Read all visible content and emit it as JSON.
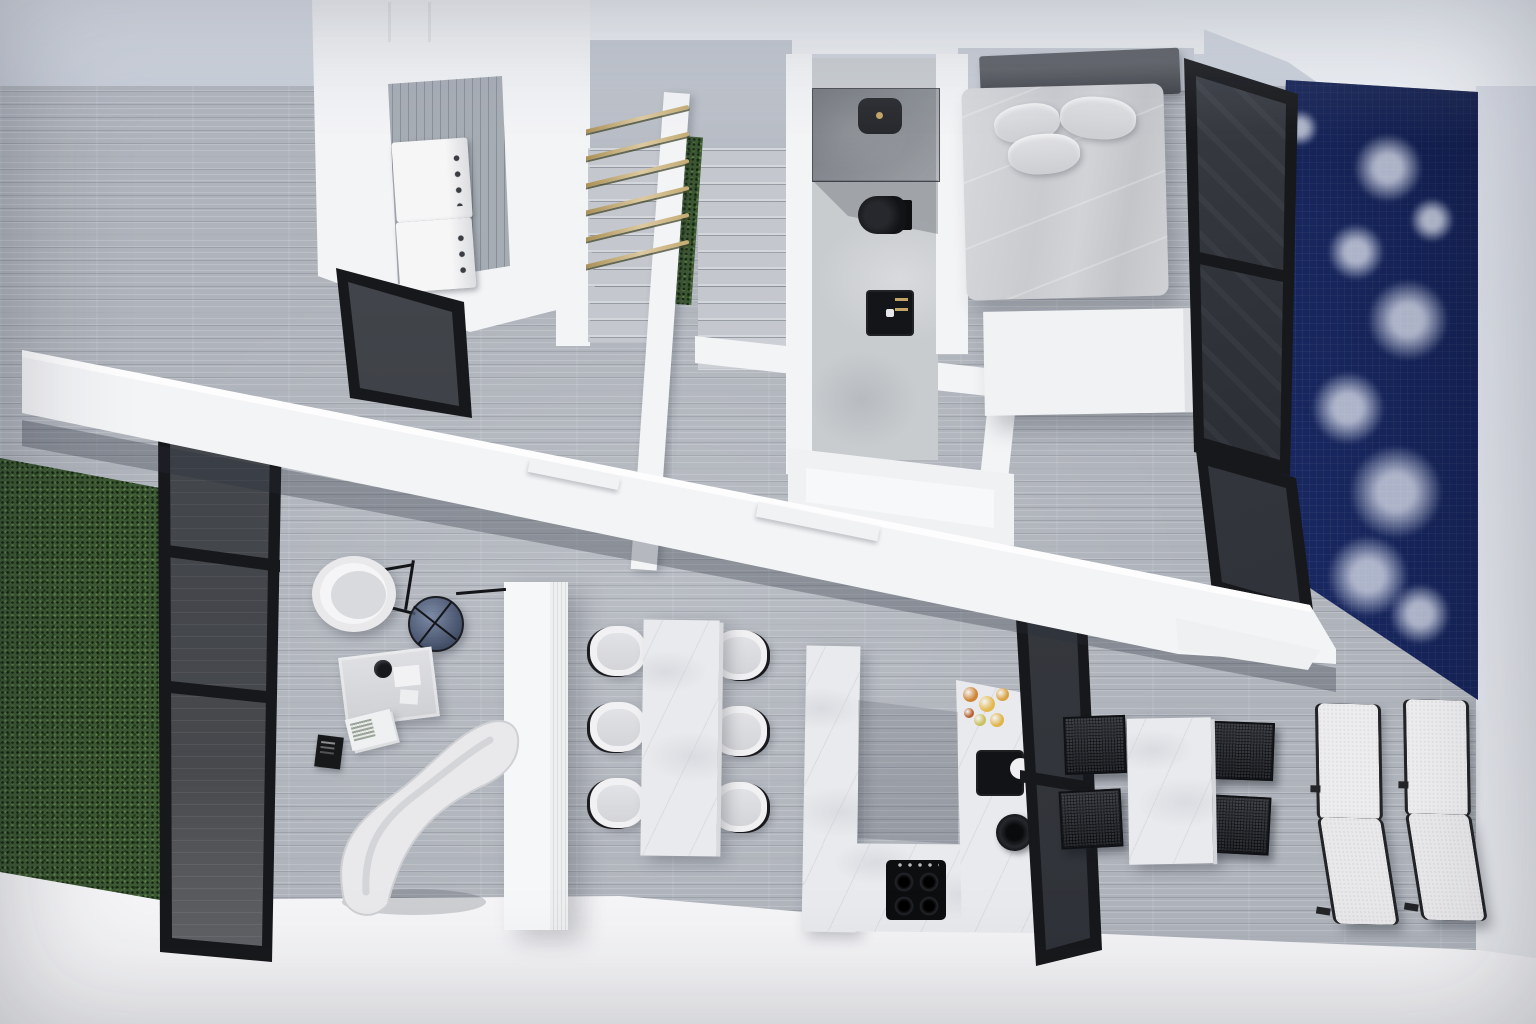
{
  "scene": {
    "description": "Top-down 3D architectural render of a modern duplex apartment with indoor pool, no visible text",
    "rooms": [
      "laundry-closet",
      "staircase",
      "bathroom",
      "bedroom",
      "pool",
      "living-area",
      "dining-area",
      "kitchen",
      "outdoor-dining-terrace",
      "green-plant-wall"
    ],
    "objects": [
      "stacked-washer-dryer",
      "stair-railing",
      "glass-shower",
      "black-toilet",
      "black-sink",
      "double-bed",
      "pillows",
      "wardrobe-unit",
      "glass-partitions",
      "dining-table-six-chairs",
      "u-shaped-kitchen-counter",
      "gas-cooktop",
      "fruit-bowl",
      "armchair",
      "round-glass-side-table",
      "side-table",
      "chaise-lounge",
      "fluted-column",
      "outdoor-table-mesh-chairs",
      "two-sun-loungers"
    ]
  },
  "palette": {
    "floor": "#b2b7bf",
    "wall": "#f3f4f6",
    "band": "#d3d8e1",
    "concrete": "#c9cccf",
    "marble": "#e9eaed",
    "grass1": "#3d5834",
    "poolA": "#1b2c6b",
    "poolB": "#2a418f",
    "black": "#17181b",
    "glass": "#5a6068",
    "gold": "#c3a366",
    "bed": "#cdcfd3",
    "hb": "#45484e",
    "seat": "#d8d9dc",
    "shell": "#f1f1f3",
    "mesh": "#26282d",
    "chaise": "#e9e9eb"
  },
  "railing": {
    "rung_count": 6,
    "rung_y": [
      130,
      157,
      184,
      211,
      238,
      265
    ]
  },
  "pool_foam": [
    {
      "x": 1388,
      "y": 168,
      "r": 34
    },
    {
      "x": 1356,
      "y": 252,
      "r": 28
    },
    {
      "x": 1408,
      "y": 320,
      "r": 40
    },
    {
      "x": 1348,
      "y": 408,
      "r": 36
    },
    {
      "x": 1396,
      "y": 492,
      "r": 46
    },
    {
      "x": 1368,
      "y": 576,
      "r": 40
    },
    {
      "x": 1420,
      "y": 614,
      "r": 30
    },
    {
      "x": 1338,
      "y": 652,
      "r": 26
    },
    {
      "x": 1300,
      "y": 128,
      "r": 18
    },
    {
      "x": 1432,
      "y": 220,
      "r": 22
    }
  ],
  "dining": {
    "left_x": 590,
    "right_x": 711,
    "left_rows": [
      626,
      702,
      778
    ],
    "right_rows": [
      630,
      706,
      782
    ],
    "chair_count": 6
  },
  "cooktop_burners": [
    {
      "x": 8,
      "y": 12
    },
    {
      "x": 33,
      "y": 12
    },
    {
      "x": 8,
      "y": 36
    },
    {
      "x": 33,
      "y": 36
    }
  ],
  "fruit": [
    {
      "x": 978,
      "y": 702,
      "r": 15,
      "c": "#cf8434"
    },
    {
      "x": 995,
      "y": 712,
      "r": 16,
      "c": "#e3b94e"
    },
    {
      "x": 1009,
      "y": 701,
      "r": 13,
      "c": "#d9a23e"
    },
    {
      "x": 986,
      "y": 726,
      "r": 12,
      "c": "#c9c05e"
    },
    {
      "x": 1004,
      "y": 727,
      "r": 14,
      "c": "#e0b44a"
    },
    {
      "x": 974,
      "y": 718,
      "r": 10,
      "c": "#b55f2e"
    }
  ],
  "outdoor_chairs": [
    {
      "x": 1064,
      "y": 716,
      "rot": -2
    },
    {
      "x": 1060,
      "y": 790,
      "rot": -3
    },
    {
      "x": 1212,
      "y": 722,
      "rot": 2
    },
    {
      "x": 1208,
      "y": 796,
      "rot": 3
    }
  ],
  "loungers": [
    {
      "x": 1312,
      "y": 698,
      "rot": 1
    },
    {
      "x": 1400,
      "y": 694,
      "rot": 1
    }
  ]
}
